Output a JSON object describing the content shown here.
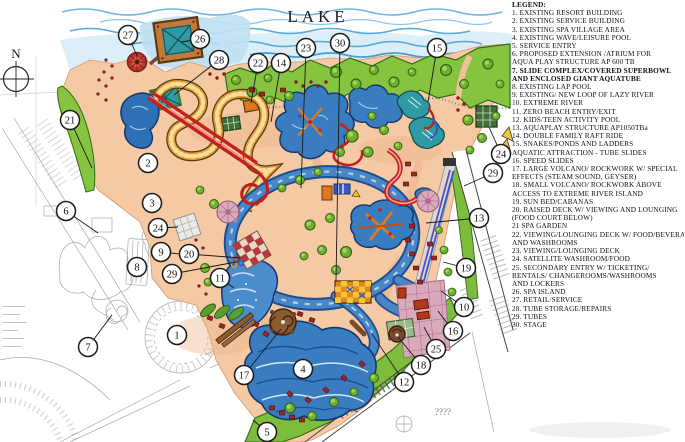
{
  "labels": {
    "lake": "LAKE",
    "compass": "N",
    "unknown_marks": "????"
  },
  "colors": {
    "water": "#3a7cc0",
    "water_edge": "#17386b",
    "sand": "#f5c9a4",
    "grass": "#86c440",
    "lazy_river_tube": "#e09c35",
    "slide_red": "#c42020",
    "slide_purple": "#6448c0",
    "teal_pond": "#2f9aa4",
    "legend_text": "#111111"
  },
  "legend": {
    "title": "LEGEND:",
    "lines": [
      {
        "text": "1. EXISTING RESORT BUILDING"
      },
      {
        "text": "2. EXISTING SERVICE BUILDING"
      },
      {
        "text": "3. EXISTING SPA VILLAGE AREA"
      },
      {
        "text": "4. EXISTING WAVE/LEISURE POOL"
      },
      {
        "text": "5. SERVICE ENTRY"
      },
      {
        "text": "6. PROPOSED EXTENSION /ATRIUM FOR"
      },
      {
        "text": "AQUA PLAY STRUCTURE AP 600 TB"
      },
      {
        "text": "7. SLIDE COMPLEX/COVERED SUPERBOWL",
        "bold": true
      },
      {
        "text": "AND ENCLOSED GIANT AQUATUBE",
        "bold": true
      },
      {
        "text": "8. EXISTING LAP POOL"
      },
      {
        "text": "9. EXISTING/ NEW LOOP OF LAZY RIVER"
      },
      {
        "text": "10. EXTREME RIVER"
      },
      {
        "text": "11. ZERO BEACH ENTRY/EXIT"
      },
      {
        "text": "12. KIDS/TEEN ACTIVITY POOL"
      },
      {
        "text": "13. AQUAPLAY STRUCTURE AP1050TBa"
      },
      {
        "text": "14. DOUBLE FAMILY RAFT RIDE"
      },
      {
        "text": "15. SNAKES/PONDS AND LADDERS"
      },
      {
        "text": "AQUATIC ATTRACTION - TUBE SLIDES"
      },
      {
        "text": "16. SPEED SLIDES"
      },
      {
        "text": "17. LARGE VOLCANO/ ROCKWORK W/ SPECIAL"
      },
      {
        "text": "EFFECTS (STEAM SOUND, GEYSER)"
      },
      {
        "text": "18. SMALL VOLCANO/ ROCKWORK ABOVE"
      },
      {
        "text": "ACCESS TO EXTREME RIVER ISLAND"
      },
      {
        "text": "19. SUN BED/CABANAS"
      },
      {
        "text": "20. RAISED DECK W/ VIEWING AND LOUNGING"
      },
      {
        "text": "(FOOD COURT BELOW)"
      },
      {
        "text": "21 SPA GARDEN"
      },
      {
        "text": "22. VIEWING/LOUNGING DECK W/ FOOD/BEVERAGE"
      },
      {
        "text": "AND WASHROOMS"
      },
      {
        "text": "23. VIEWING/LOUNGING DECK"
      },
      {
        "text": "24. SATELLITE WASHROOM/FOOD"
      },
      {
        "text": "25. SECONDARY ENTRY W/ TICKETING/"
      },
      {
        "text": "RENTALS/ CHANGEROOMS/WASHROOMS"
      },
      {
        "text": "AND LOCKERS"
      },
      {
        "text": "26. SPA ISLAND"
      },
      {
        "text": "27. RETAIL/SERVICE"
      },
      {
        "text": "28. TUBE STORAGE/REPAIRS"
      },
      {
        "text": "29. TUBES"
      },
      {
        "text": "30. STAGE"
      }
    ]
  },
  "map_markers": [
    {
      "n": "27",
      "x": 128,
      "y": 35,
      "lx": 137,
      "ly": 56
    },
    {
      "n": "26",
      "x": 200,
      "y": 39,
      "lx": 181,
      "ly": 42
    },
    {
      "n": "28",
      "x": 219,
      "y": 60,
      "lx": 174,
      "ly": 95
    },
    {
      "n": "22",
      "x": 258,
      "y": 63,
      "lx": 251,
      "ly": 103
    },
    {
      "n": "14",
      "x": 281,
      "y": 63,
      "lx": 271,
      "ly": 122
    },
    {
      "n": "23",
      "x": 306,
      "y": 48,
      "lx": 301,
      "ly": 188
    },
    {
      "n": "30",
      "x": 340,
      "y": 43,
      "lx": 336,
      "ly": 281
    },
    {
      "n": "15",
      "x": 437,
      "y": 48,
      "lx": 428,
      "ly": 102
    },
    {
      "n": "21",
      "x": 70,
      "y": 120,
      "lx": 92,
      "ly": 168
    },
    {
      "n": "2",
      "x": 148,
      "y": 163
    },
    {
      "n": "3",
      "x": 152,
      "y": 203
    },
    {
      "n": "6",
      "x": 66,
      "y": 211,
      "lx": 98,
      "ly": 233
    },
    {
      "n": "24",
      "x": 158,
      "y": 228,
      "lx": 178,
      "ly": 227
    },
    {
      "n": "9",
      "x": 161,
      "y": 252,
      "lx": 198,
      "ly": 256
    },
    {
      "n": "20",
      "x": 189,
      "y": 254,
      "lx": 241,
      "ly": 258
    },
    {
      "n": "29",
      "x": 172,
      "y": 274,
      "lx": 236,
      "ly": 262
    },
    {
      "n": "11",
      "x": 220,
      "y": 278,
      "lx": 234,
      "ly": 288
    },
    {
      "n": "8",
      "x": 137,
      "y": 267,
      "lx": 140,
      "ly": 259
    },
    {
      "n": "1",
      "x": 177,
      "y": 335
    },
    {
      "n": "7",
      "x": 88,
      "y": 347,
      "lx": 112,
      "ly": 315
    },
    {
      "n": "17",
      "x": 244,
      "y": 375,
      "lx": 281,
      "ly": 329
    },
    {
      "n": "4",
      "x": 303,
      "y": 369
    },
    {
      "n": "5",
      "x": 267,
      "y": 432,
      "lx": 253,
      "ly": 420
    },
    {
      "n": "12",
      "x": 404,
      "y": 382,
      "lx": 372,
      "ly": 334
    },
    {
      "n": "18",
      "x": 421,
      "y": 365,
      "lx": 398,
      "ly": 337
    },
    {
      "n": "25",
      "x": 436,
      "y": 349,
      "lx": 424,
      "ly": 327
    },
    {
      "n": "16",
      "x": 453,
      "y": 331,
      "lx": 438,
      "ly": 311
    },
    {
      "n": "10",
      "x": 464,
      "y": 307,
      "lx": 441,
      "ly": 291
    },
    {
      "n": "19",
      "x": 466,
      "y": 268,
      "lx": 443,
      "ly": 262
    },
    {
      "n": "13",
      "x": 479,
      "y": 218,
      "lx": 426,
      "ly": 223
    },
    {
      "n": "29",
      "x": 493,
      "y": 173,
      "lx": 464,
      "ly": 186
    },
    {
      "n": "24",
      "x": 501,
      "y": 154,
      "lx": 489,
      "ly": 127
    }
  ]
}
